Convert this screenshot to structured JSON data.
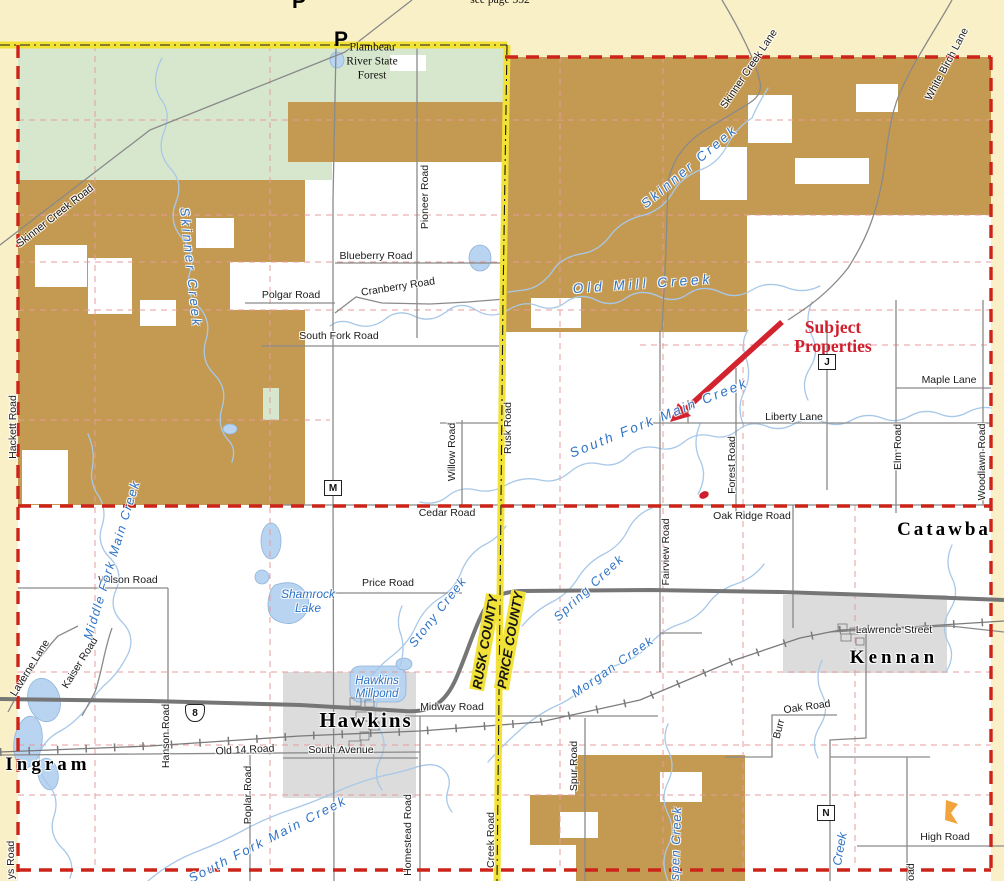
{
  "map": {
    "description": "Plat-style county road map, Rusk/Price county line area (Hawkins, Ingram, Kennan, Catawba)",
    "colors": {
      "county_line_road_yellow": "#f2e235",
      "boundary_red_dashed": "#cc2418",
      "section_line_pink": "#e59c9c",
      "state_forest_green": "#d7e7cd",
      "public_land_brown": "#c49a52",
      "urban_gray": "#dcdcdc",
      "water_fill_blue": "#b8d4f0",
      "creek_line_blue": "#a8c8e8",
      "creek_label_blue": "#2e73c5",
      "annotation_red": "#cf1f2c"
    },
    "labels": [
      {
        "id": "see-page-note",
        "t": "see page 352",
        "x": 500,
        "y": 1,
        "type": "page",
        "size": 11.5
      },
      {
        "id": "flambeau-forest-label",
        "t": "Flambeau\nRiver State\nForest",
        "x": 372,
        "y": 62,
        "type": "forest",
        "size": 11.5
      },
      {
        "id": "skinner-creek-road-label",
        "t": "Skinner Creek Road",
        "x": 55,
        "y": 216,
        "rot": -38,
        "type": "road"
      },
      {
        "id": "hackett-road-label",
        "t": "Hackett Road",
        "x": 13,
        "y": 427,
        "rot": -90,
        "type": "road"
      },
      {
        "id": "pioneer-road-label",
        "t": "Pioneer Road",
        "x": 425,
        "y": 197,
        "rot": -90,
        "type": "road"
      },
      {
        "id": "blueberry-road-label",
        "t": "Blueberry Road",
        "x": 376,
        "y": 256,
        "type": "road"
      },
      {
        "id": "polgar-road-label",
        "t": "Polgar Road",
        "x": 291,
        "y": 295,
        "type": "road"
      },
      {
        "id": "cranberry-road-label",
        "t": "Cranberry Road",
        "x": 398,
        "y": 287,
        "rot": -9,
        "type": "road"
      },
      {
        "id": "south-fork-road-label",
        "t": "South Fork Road",
        "x": 339,
        "y": 336,
        "type": "road"
      },
      {
        "id": "willow-road-label",
        "t": "Willow Road",
        "x": 452,
        "y": 452,
        "rot": -90,
        "type": "road"
      },
      {
        "id": "rusk-road-label",
        "t": "Rusk Road",
        "x": 508,
        "y": 428,
        "rot": -90,
        "type": "road"
      },
      {
        "id": "cedar-road-label",
        "t": "Cedar Road",
        "x": 447,
        "y": 513,
        "type": "road"
      },
      {
        "id": "skinner-creek-lane-label",
        "t": "Skinner Creek Lane",
        "x": 749,
        "y": 69,
        "rot": -56,
        "type": "road"
      },
      {
        "id": "white-birch-lane-label",
        "t": "White Birch Lane",
        "x": 947,
        "y": 64,
        "rot": -62,
        "type": "road"
      },
      {
        "id": "maple-lane-label",
        "t": "Maple Lane",
        "x": 949,
        "y": 380,
        "type": "road"
      },
      {
        "id": "liberty-lane-label",
        "t": "Liberty Lane",
        "x": 794,
        "y": 417,
        "type": "road"
      },
      {
        "id": "elm-road-label",
        "t": "Elm Road",
        "x": 898,
        "y": 447,
        "rot": -90,
        "type": "road"
      },
      {
        "id": "woodlawn-road-label",
        "t": "Woodlawn Road",
        "x": 982,
        "y": 462,
        "rot": -90,
        "type": "road"
      },
      {
        "id": "forest-road-label",
        "t": "Forest Road",
        "x": 732,
        "y": 465,
        "rot": -90,
        "type": "road"
      },
      {
        "id": "oak-ridge-road-label",
        "t": "Oak Ridge Road",
        "x": 752,
        "y": 516,
        "type": "road"
      },
      {
        "id": "fairview-road-label",
        "t": "Fairview Road",
        "x": 666,
        "y": 552,
        "rot": -90,
        "type": "road"
      },
      {
        "id": "wilson-road-label",
        "t": "Wilson Road",
        "x": 128,
        "y": 580,
        "type": "road"
      },
      {
        "id": "price-road-label",
        "t": "Price Road",
        "x": 388,
        "y": 583,
        "type": "road"
      },
      {
        "id": "kaiser-road-label",
        "t": "Kaiser Road",
        "x": 80,
        "y": 663,
        "rot": -58,
        "type": "road"
      },
      {
        "id": "laverne-lane-label",
        "t": "Laverne Lane",
        "x": 30,
        "y": 668,
        "rot": -58,
        "type": "road"
      },
      {
        "id": "hanson-road-label",
        "t": "Hanson Road",
        "x": 166,
        "y": 736,
        "rot": -90,
        "type": "road"
      },
      {
        "id": "old-14-road-label",
        "t": "Old 14 Road",
        "x": 245,
        "y": 750,
        "rot": -3,
        "type": "road"
      },
      {
        "id": "midway-road-label",
        "t": "Midway Road",
        "x": 452,
        "y": 707,
        "type": "road"
      },
      {
        "id": "south-avenue-label",
        "t": "South Avenue",
        "x": 341,
        "y": 750,
        "type": "road"
      },
      {
        "id": "poplar-road-label",
        "t": "Poplar Road",
        "x": 248,
        "y": 795,
        "rot": -90,
        "type": "road"
      },
      {
        "id": "homestead-road-label",
        "t": "Homestead Road",
        "x": 408,
        "y": 835,
        "rot": -90,
        "type": "road"
      },
      {
        "id": "spur-road-label",
        "t": "Spur Road",
        "x": 574,
        "y": 766,
        "rot": -90,
        "type": "road"
      },
      {
        "id": "creek-road-label",
        "t": "Creek Road",
        "x": 491,
        "y": 840,
        "rot": -90,
        "type": "road"
      },
      {
        "id": "lawrence-street-label",
        "t": "Lawrence Street",
        "x": 894,
        "y": 630,
        "type": "road"
      },
      {
        "id": "burr-oak-road-label",
        "t": "Oak Road",
        "x": 807,
        "y": 707,
        "rot": -8,
        "type": "road"
      },
      {
        "id": "burr-oak-road-label-2",
        "t": "Burr",
        "x": 779,
        "y": 729,
        "rot": -75,
        "type": "road"
      },
      {
        "id": "high-road-label",
        "t": "High Road",
        "x": 945,
        "y": 837,
        "type": "road"
      },
      {
        "id": "partial-road-label",
        "t": "oad",
        "x": 911,
        "y": 872,
        "rot": -90,
        "type": "road"
      },
      {
        "id": "ys-road-label",
        "t": "ys Road",
        "x": 11,
        "y": 860,
        "rot": -90,
        "type": "road"
      },
      {
        "id": "rusk-county-label",
        "t": "RUSK COUNTY",
        "x": 485,
        "y": 642,
        "rot": -80,
        "type": "county"
      },
      {
        "id": "price-county-label",
        "t": "PRICE COUNTY",
        "x": 510,
        "y": 640,
        "rot": -80,
        "type": "county"
      },
      {
        "id": "subject-properties-note",
        "t": "Subject\nProperties",
        "x": 833,
        "y": 337,
        "type": "note",
        "size": 17.5
      },
      {
        "id": "skinner-creek-label-west",
        "t": "Skinner Creek",
        "x": 190,
        "y": 268,
        "rot": 84,
        "type": "creek",
        "size": 13,
        "ls": 3
      },
      {
        "id": "skinner-creek-label-east",
        "t": "Skinner Creek",
        "x": 690,
        "y": 167,
        "rot": -40,
        "type": "creek",
        "size": 13,
        "ls": 3
      },
      {
        "id": "old-mill-creek-label",
        "t": "Old Mill Creek",
        "x": 643,
        "y": 284,
        "rot": -4,
        "type": "creek",
        "size": 13.5,
        "ls": 4
      },
      {
        "id": "south-fork-main-creek-label",
        "t": "South Fork Main Creek",
        "x": 659,
        "y": 418,
        "rot": -22,
        "type": "creek",
        "size": 13.5,
        "ls": 2.5
      },
      {
        "id": "middle-fork-main-creek-label",
        "t": "Middle Fork Main Creek",
        "x": 112,
        "y": 560,
        "rot": -73,
        "type": "creek",
        "size": 12.5,
        "ls": 1.5
      },
      {
        "id": "stony-creek-label",
        "t": "Stony Creek",
        "x": 438,
        "y": 612,
        "rot": -52,
        "type": "creek",
        "size": 12.5,
        "ls": 1.5
      },
      {
        "id": "spring-creek-label",
        "t": "Spring Creek",
        "x": 589,
        "y": 588,
        "rot": -43,
        "type": "creek",
        "size": 12.5,
        "ls": 1.5
      },
      {
        "id": "morgan-creek-label",
        "t": "Morgan Creek",
        "x": 613,
        "y": 667,
        "rot": -35,
        "type": "creek",
        "size": 12.5,
        "ls": 1.5
      },
      {
        "id": "shamrock-lake-label",
        "t": "Shamrock\nLake",
        "x": 308,
        "y": 602,
        "type": "creek",
        "size": 12
      },
      {
        "id": "hawkins-millpond-label",
        "t": "Hawkins\nMillpond",
        "x": 377,
        "y": 688,
        "type": "creek",
        "size": 11.5
      },
      {
        "id": "south-fork-main-creek-label-lower",
        "t": "South Fork Main Creek",
        "x": 268,
        "y": 840,
        "rot": -27,
        "type": "creek",
        "size": 13,
        "ls": 2
      },
      {
        "id": "aspen-creek-label",
        "t": "Aspen Creek",
        "x": 676,
        "y": 848,
        "rot": -88,
        "type": "creek",
        "size": 12.5,
        "ls": 1
      },
      {
        "id": "creek-partial-label",
        "t": "Creek",
        "x": 840,
        "y": 849,
        "rot": -80,
        "type": "creek",
        "size": 12.5
      },
      {
        "id": "town-hawkins",
        "t": "Hawkins",
        "x": 366,
        "y": 720,
        "type": "town",
        "size": 21,
        "ls": 2
      },
      {
        "id": "town-ingram",
        "t": "Ingram",
        "x": 48,
        "y": 765,
        "type": "town",
        "size": 19,
        "ls": 4
      },
      {
        "id": "town-kennan",
        "t": "Kennan",
        "x": 894,
        "y": 658,
        "type": "town",
        "size": 19,
        "ls": 4
      },
      {
        "id": "town-catawba",
        "t": "Catawba",
        "x": 944,
        "y": 530,
        "type": "town",
        "size": 19,
        "ls": 3
      }
    ],
    "markers": [
      {
        "kind": "box",
        "t": "M",
        "x": 333,
        "y": 488,
        "id": "county-road-m-marker"
      },
      {
        "kind": "box",
        "t": "J",
        "x": 827,
        "y": 362,
        "id": "county-road-j-marker"
      },
      {
        "kind": "box",
        "t": "N",
        "x": 826,
        "y": 813,
        "id": "county-road-n-marker"
      },
      {
        "kind": "shield",
        "t": "8",
        "x": 195,
        "y": 713,
        "id": "us-8-shield"
      },
      {
        "kind": "p",
        "t": "P",
        "x": 341,
        "y": 40,
        "id": "p-marker"
      },
      {
        "kind": "p",
        "t": "P",
        "x": 299,
        "y": 2,
        "id": "p-marker-top"
      }
    ]
  }
}
